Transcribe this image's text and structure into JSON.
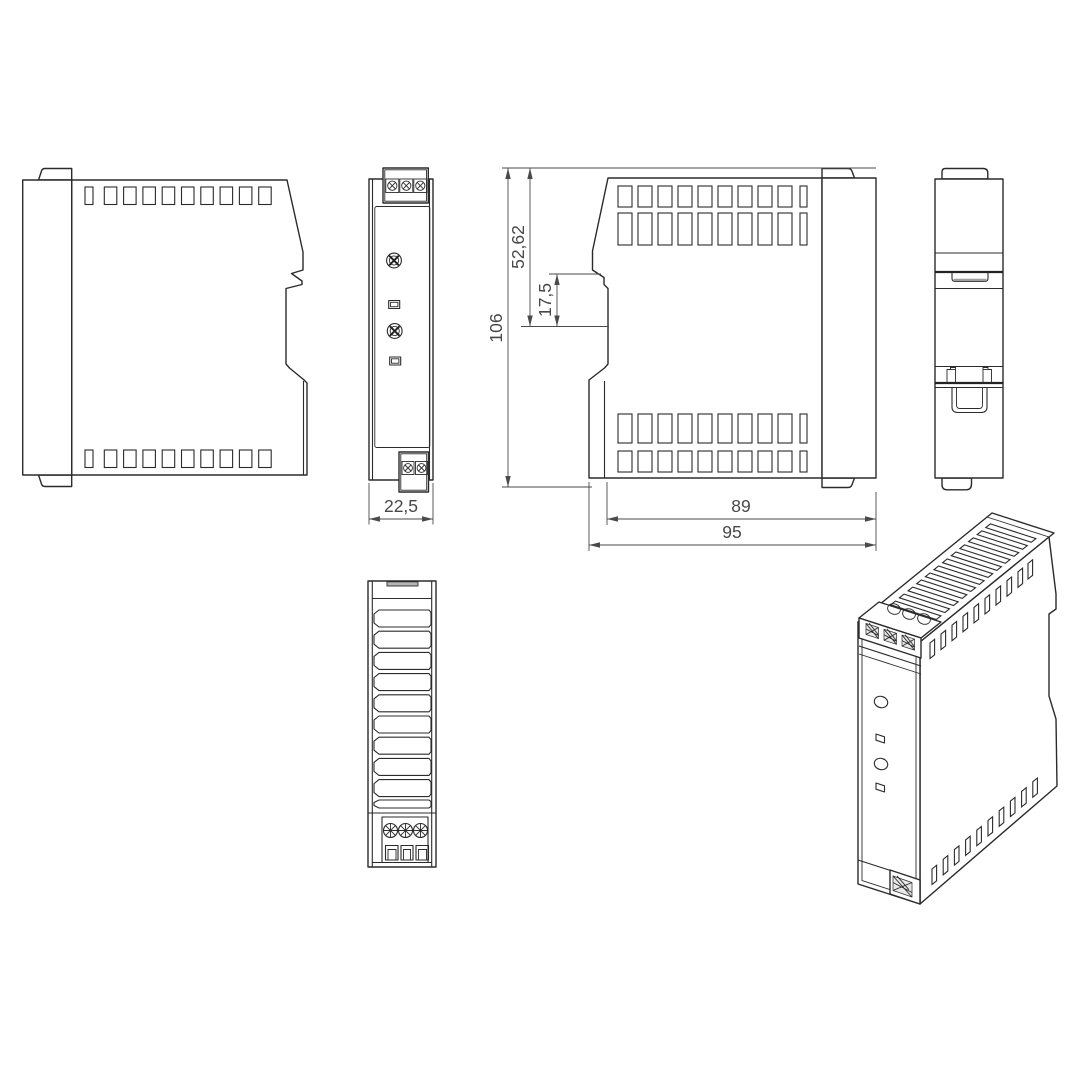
{
  "drawing": {
    "dim_front_width": "22,5",
    "dim_overall_height": "106",
    "dim_upper_height": "52,62",
    "dim_clip_offset": "17,5",
    "dim_body_depth": "89",
    "dim_overall_depth": "95",
    "colors": {
      "line": "#2b2b2b",
      "dimension": "#4a4a4a",
      "background": "#ffffff"
    }
  }
}
